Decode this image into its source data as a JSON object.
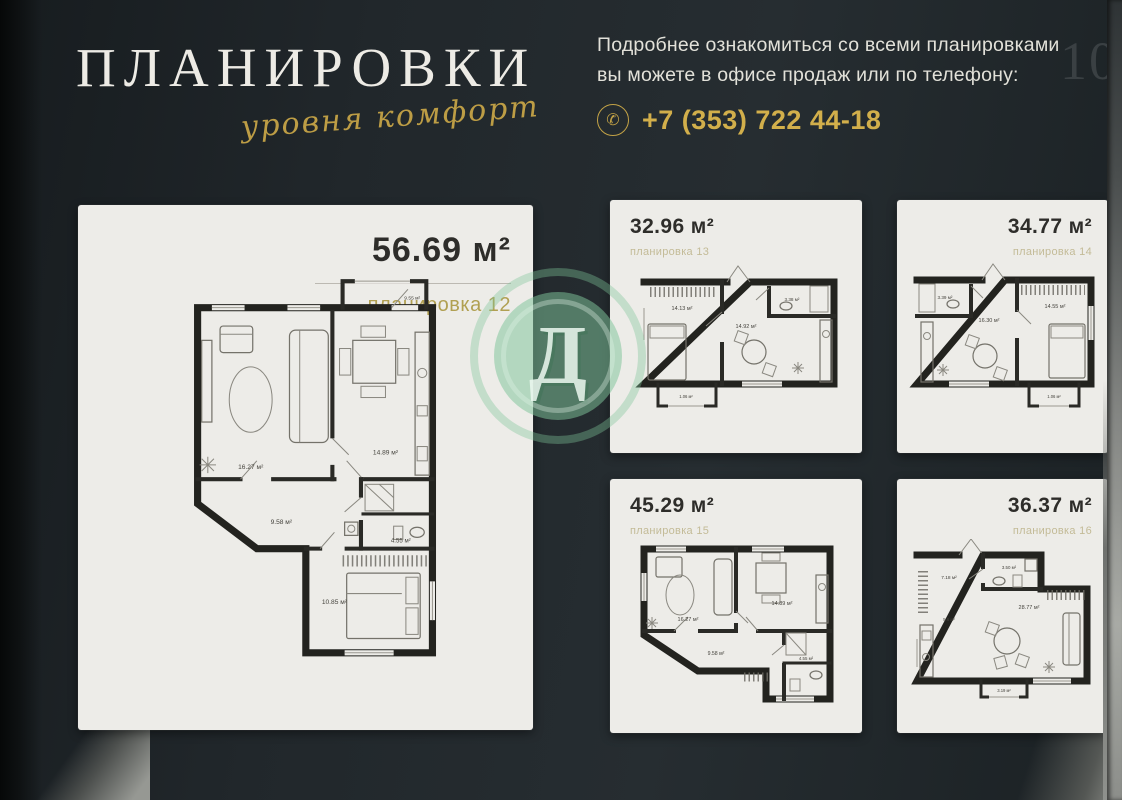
{
  "header": {
    "title": "ПЛАНИРОВКИ",
    "subtitle_script": "уровня комфорт",
    "info_line1": "Подробнее ознакомиться со всеми планировками",
    "info_line2": "вы можете в офисе продаж или по телефону:",
    "phone": "+7 (353) 722 44-18",
    "phone_icon": "phone-icon",
    "page_number": "10"
  },
  "colors": {
    "background_dark": "#21272b",
    "card_paper": "#edece8",
    "accent_gold": "#c2a246",
    "watermark_green": "#7ec499",
    "title_white": "#edebe5"
  },
  "watermark": {
    "letter": "Д"
  },
  "plans": {
    "plan12": {
      "area": "56.69 м²",
      "label": "планировка 12",
      "rooms": {
        "balcony": "9.55 м²",
        "living": "16.27 м²",
        "kitchen": "14.89 м²",
        "hall": "9.58 м²",
        "bath": "4.55 м²",
        "bedroom": "10.85 м²"
      }
    },
    "plan13": {
      "area": "32.96 м²",
      "label": "планировка 13",
      "rooms": {
        "bedroom": "14.13 м²",
        "living": "14.92 м²",
        "bath": "3.38 м²",
        "balcony": "1.06 м²"
      }
    },
    "plan14": {
      "area": "34.77 м²",
      "label": "планировка 14",
      "rooms": {
        "bath": "3.39 м²",
        "living": "16.30 м²",
        "bedroom": "14.55 м²",
        "balcony": "1.06 м²"
      }
    },
    "plan15": {
      "area": "45.29 м²",
      "label": "планировка 15",
      "rooms": {
        "living": "16.27 м²",
        "kitchen": "14.89 м²",
        "hall": "9.58 м²",
        "bath": "4.55 м²"
      }
    },
    "plan16": {
      "area": "36.37 м²",
      "label": "планировка 16",
      "rooms": {
        "hall": "7.18 м²",
        "bath": "3.50 м²",
        "kitchen": "5.6 м²",
        "living": "28.77 м²",
        "balcony": "3.19 м²"
      }
    }
  }
}
